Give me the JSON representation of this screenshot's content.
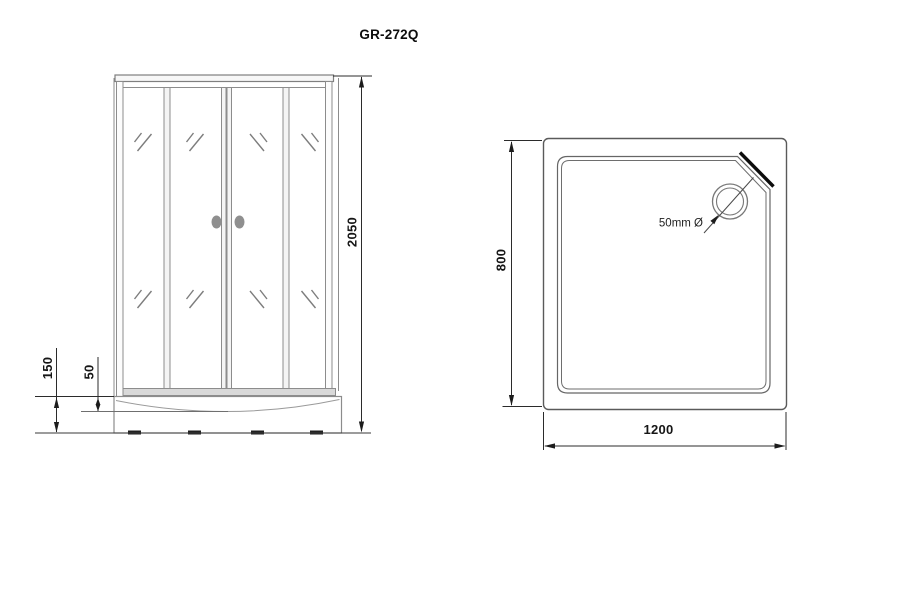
{
  "drawing": {
    "model": "GR-272Q"
  },
  "front_view": {
    "dim_total_height": "2050",
    "dim_base_height": "150",
    "dim_rim_height": "50"
  },
  "top_view": {
    "dim_depth": "800",
    "dim_width": "1200",
    "drain_label": "50mm Ø"
  },
  "colors": {
    "background": "#ffffff",
    "frame_outline": "#8c8c8c",
    "dimension_line": "#2b2b2b",
    "chamfer_accent": "#0d0d0d",
    "handle_fill": "#8f8f8f",
    "track_fill": "#d9d9d9"
  }
}
